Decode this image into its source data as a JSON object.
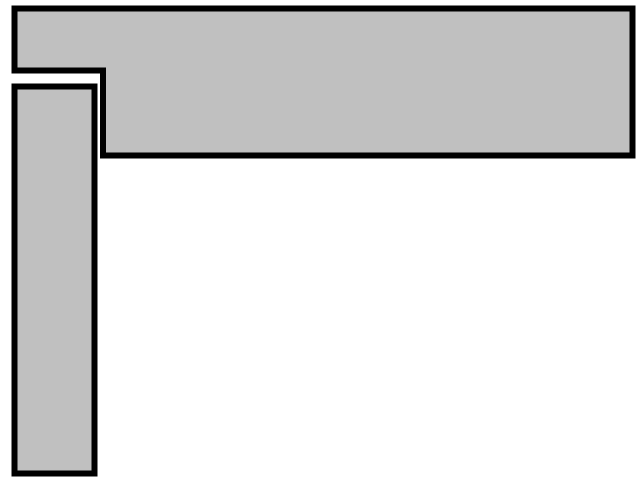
{
  "canvas": {
    "width": 640,
    "height": 480,
    "background": "#ffffff"
  },
  "figure": {
    "fill": "#c0c0c0",
    "stroke": "#000000",
    "stroke_width": 6
  },
  "shapes": {
    "horizontal_bar": {
      "points": "14.5,8.5 632.5,8.5 632.5,155.5 103,155.5 103,70.5 14.5,70.5"
    },
    "vertical_bar": {
      "points": "14.5,86.5 94.5,86.5 94.5,473.5 14.5,473.5"
    }
  }
}
